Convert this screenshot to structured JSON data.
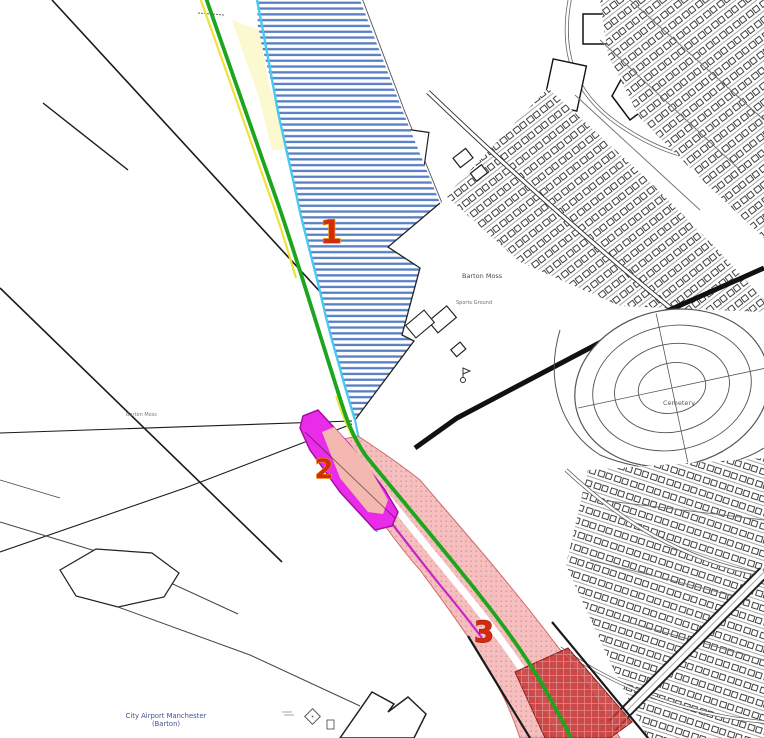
{
  "map": {
    "description": "Planning overlay map, Barton / Eccles area",
    "region_labels": {
      "barton_moss_main": "Barton Moss",
      "sports_ground": "Sports Ground",
      "cemetery": "Cemetery",
      "barton_moss_west": "Barton Moss",
      "airport_line1": "City Airport Manchester",
      "airport_line2": "(Barton)"
    },
    "zone_markers": {
      "zone1": "1",
      "zone2": "2",
      "zone3": "3"
    },
    "colors": {
      "route_green": "#1da51d",
      "route_yellow": "#ece23a",
      "boundary_cyan": "#49c8f2",
      "zone1_hatch_blue": "#4a74bf",
      "zone2_magenta": "#ea2bea",
      "zone2_inner_salmon": "#f6c0ae",
      "zone3_pink": "#f4b6b6",
      "zone3_dark_red": "#c63232",
      "zone3_edge_magenta": "#c922c9",
      "numeral_fill": "#d42a10",
      "numeral_halo_yellow": "#e8a00a",
      "numeral_halo_dark": "#8a1206",
      "base_linework": "#1a1a1a",
      "airport_label_blue": "#44518f"
    }
  }
}
